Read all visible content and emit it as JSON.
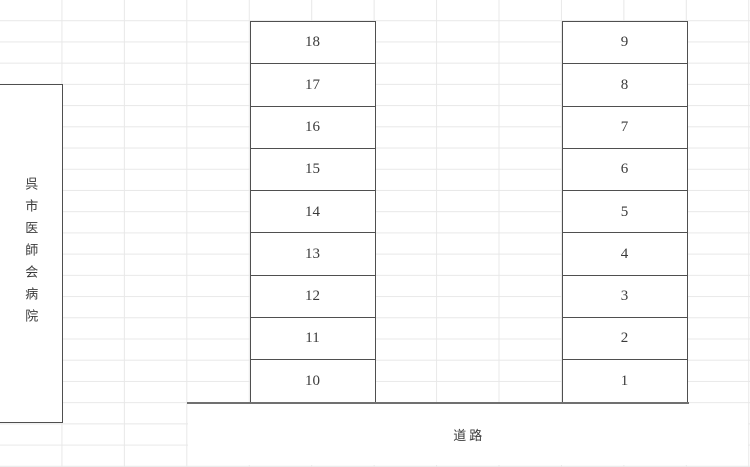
{
  "colors": {
    "background": "#ffffff",
    "gridline": "#e8e8e8",
    "cell_border": "#4f4f4f",
    "road_edge": "#707070",
    "text": "#3b3b3b"
  },
  "hospital_cell": {
    "label": "呉市医師会病院"
  },
  "road_cell": {
    "label": "道路"
  },
  "left_column": {
    "cells": [
      "18",
      "17",
      "16",
      "15",
      "14",
      "13",
      "12",
      "11",
      "10"
    ]
  },
  "right_column": {
    "cells": [
      "9",
      "8",
      "7",
      "6",
      "5",
      "4",
      "3",
      "2",
      "1"
    ]
  }
}
